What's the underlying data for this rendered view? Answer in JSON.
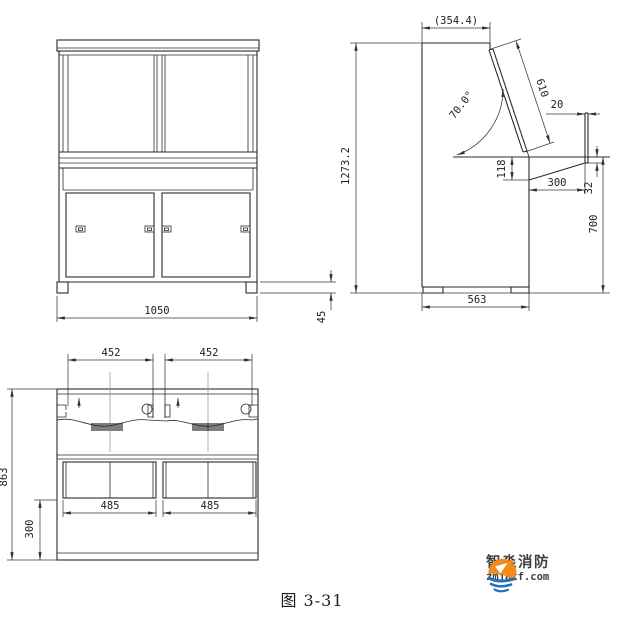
{
  "figure": {
    "caption": "图 3-31"
  },
  "logo": {
    "brand": "智淼消防",
    "domain": "zmjaxf.com",
    "orange": "#f28a1c",
    "blue": "#2272b9",
    "text_color": "#3f3f3f"
  },
  "drawing": {
    "line_color": "#2b2b2b",
    "dim_color": "#3a3a3a",
    "centerline_color": "#9a9a9a",
    "background": "#ffffff"
  },
  "views": {
    "front": {
      "label": "front-elevation",
      "dims": {
        "width": "1050",
        "foot_height": "45"
      }
    },
    "side": {
      "label": "side-elevation",
      "dims": {
        "top_depth": "(354.4)",
        "total_height": "1273.2",
        "panel_length": "610",
        "panel_angle": "70.0°",
        "panel_thickness": "20",
        "back_thickness": "118",
        "desk_depth": "300",
        "front_edge_thickness": "32",
        "desk_height": "700",
        "base_depth": "563"
      }
    },
    "plan": {
      "label": "plan-view",
      "dims": {
        "panel_left_width": "452",
        "panel_right_width": "452",
        "total_depth": "863",
        "front_depth": "300",
        "opening_left": "485",
        "opening_right": "485"
      }
    }
  }
}
